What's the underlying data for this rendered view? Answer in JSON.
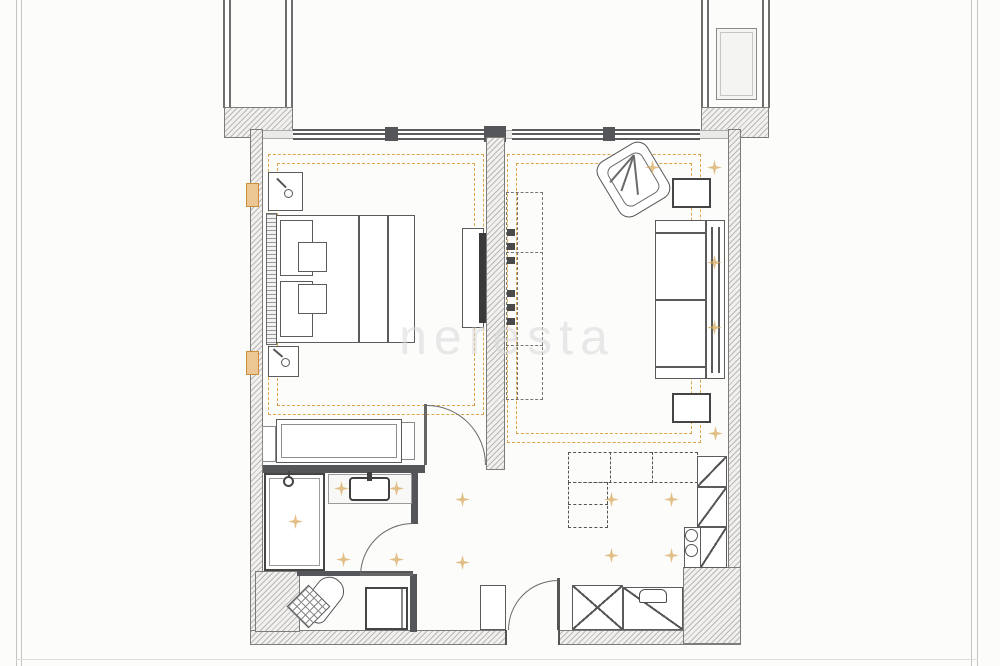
{
  "image": {
    "type": "architectural-floor-plan",
    "subject": "one-bedroom apartment, furnished top-down plan with two balconies",
    "watermark": "neresta"
  },
  "palette": {
    "background": "#fcfcfb",
    "wall": "#55565a",
    "hatch_fill": "#f1f0ee",
    "furniture_line": "#5b5b5b",
    "window_line": "#9b9b9b",
    "ceiling_zone_dash": "#dca54c",
    "spotlight": "#d9a85c",
    "frame_line": "#c4c4c4",
    "watermark_color": "#d9d9d9"
  },
  "rooms": [
    {
      "id": "balcony-left",
      "label": "balcony",
      "furniture": []
    },
    {
      "id": "balcony-right",
      "label": "balcony",
      "furniture": [
        "outdoor-unit"
      ]
    },
    {
      "id": "bedroom",
      "label": "bedroom",
      "ceiling_zone": true,
      "furniture": [
        "double-bed",
        "pillows",
        "nightstand-with-lamp",
        "nightstand-with-lamp",
        "headboard-panel",
        "wardrobe",
        "tv-sideboard",
        "wall-tv",
        "radiator",
        "radiator"
      ]
    },
    {
      "id": "living-room",
      "label": "living room",
      "ceiling_zone": true,
      "furniture": [
        "corner-armchair",
        "side-table",
        "side-table",
        "sofa",
        "shelving-unit"
      ]
    },
    {
      "id": "kitchen",
      "label": "open kitchen",
      "furniture": [
        "l-shaped-counter",
        "tall-cabinet",
        "tall-cabinet",
        "hob-sink-unit"
      ]
    },
    {
      "id": "bathroom",
      "label": "bathroom",
      "furniture": [
        "walk-in-shower",
        "vanity-with-basin",
        "toilet",
        "washing-machine"
      ]
    },
    {
      "id": "hallway",
      "label": "entrance hall",
      "furniture": [
        "entry-cabinet",
        "shoe-cabinet",
        "mirrored-cabinet"
      ]
    }
  ],
  "symbols": {
    "doors": [
      "bedroom-door",
      "bathroom-door",
      "entry-door"
    ],
    "window_segments": 4,
    "spotlights": 16,
    "ceiling_zones": 2,
    "balconies": 2
  }
}
